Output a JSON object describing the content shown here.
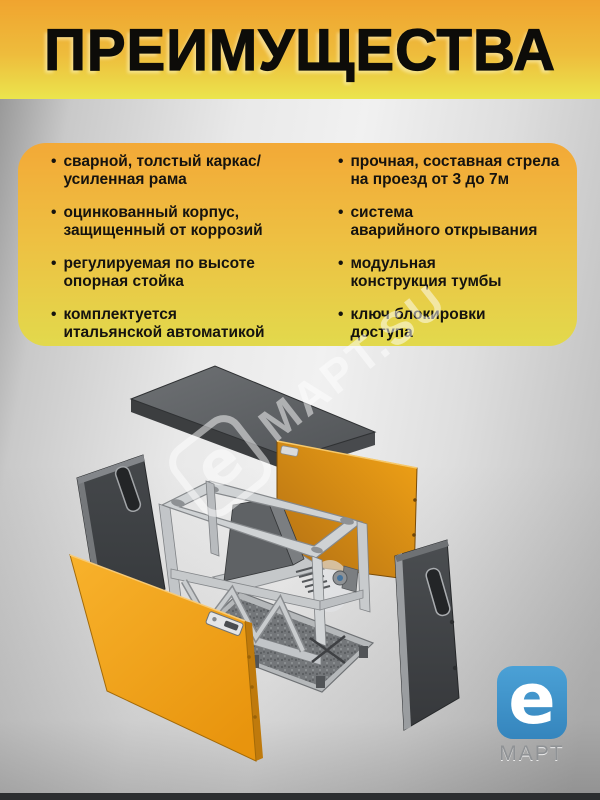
{
  "title": "ПРЕИМУЩЕСТВА",
  "advantages": {
    "bullet": "•",
    "left": [
      {
        "l1": "сварной, толстый каркас/",
        "l2": "усиленная рама"
      },
      {
        "l1": "оцинкованный корпус,",
        "l2": "защищенный от коррозий"
      },
      {
        "l1": "регулируемая по высоте",
        "l2": "опорная стойка"
      },
      {
        "l1": "комплектуется",
        "l2": "итальянской автоматикой"
      }
    ],
    "right": [
      {
        "l1": "прочная, составная стрела",
        "l2": "на проезд от 3 до 7м"
      },
      {
        "l1": "система",
        "l2": "аварийного открывания"
      },
      {
        "l1": "модульная",
        "l2": "конструкция тумбы"
      },
      {
        "l1": "ключ блокировки",
        "l2": "доступа"
      }
    ]
  },
  "watermark": {
    "logo_letter": "e",
    "text": "МАРТ.SU"
  },
  "brand_logo": {
    "letter": "e",
    "caption": "МАРТ"
  },
  "colors": {
    "header_orange": "#F0A42F",
    "header_yellow": "#EBE54D",
    "card_top": "#F3A937",
    "card_bottom": "#E2D94C",
    "machine_orange": "#F2A31F",
    "cabinet_gray": "#44474A",
    "logo_blue": "#3F8FC6"
  }
}
